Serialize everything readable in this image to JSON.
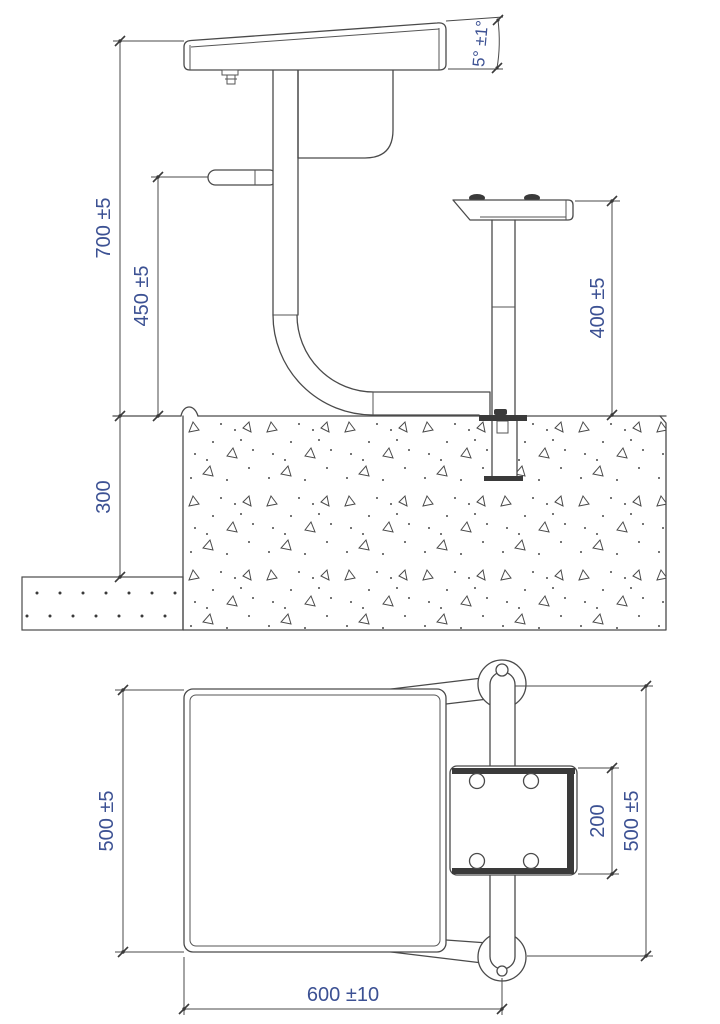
{
  "drawing": {
    "side_view": {
      "dims": {
        "angle": "5° ±1°",
        "overall_height": "700 ±5",
        "hook_height": "450 ±5",
        "seat_height": "400 ±5",
        "foundation_depth": "300"
      }
    },
    "plan_view": {
      "dims": {
        "depth_left": "500 ±5",
        "seat_depth": "200",
        "post_span": "500 ±5",
        "width": "600 ±10"
      }
    }
  }
}
